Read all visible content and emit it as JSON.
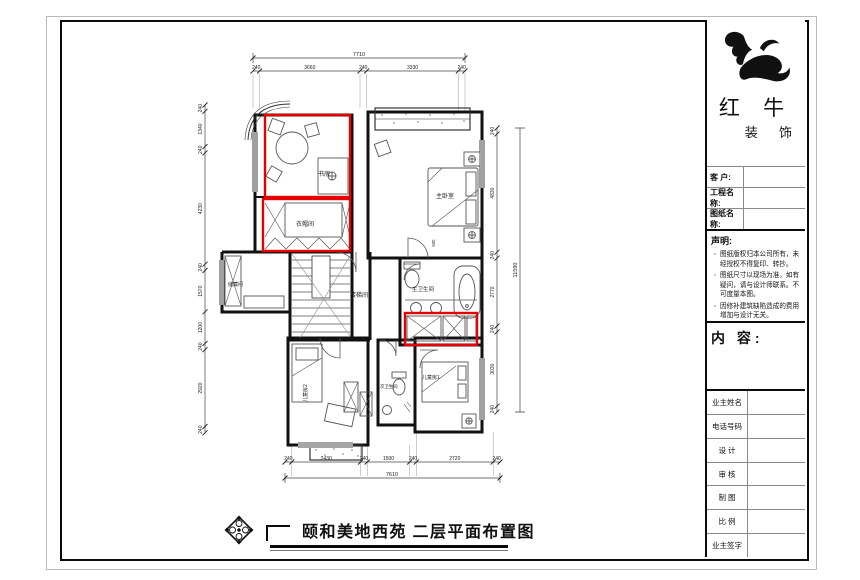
{
  "sheet": {
    "title": "颐和美地西苑  二层平面布置图"
  },
  "title_block": {
    "brand_main": "红 牛",
    "brand_sub": "装 饰",
    "fields": [
      {
        "label": "客  户:"
      },
      {
        "label": "工程名称:"
      },
      {
        "label": "图纸名称:"
      }
    ],
    "statement_heading": "声明:",
    "statement_items": [
      "图纸版权归本公司所有，未经授权不得复印、转抄。",
      "图纸尺寸以现场为准，如有疑问，请与设计师联系。不可度量本图。",
      "因修补建筑缺陷造成的费用增加与设计无关。"
    ],
    "content_label": "内 容:",
    "bottom_fields": [
      {
        "label": "业主姓名"
      },
      {
        "label": "电话号码"
      },
      {
        "label": "设 计"
      },
      {
        "label": "审 核"
      },
      {
        "label": "制 图"
      },
      {
        "label": "比 例"
      },
      {
        "label": "业主签字"
      }
    ]
  },
  "drawing": {
    "rooms": {
      "study": "书房",
      "cloakroom": "衣帽间",
      "master_bedroom": "主卧室",
      "storage": "储藏间",
      "stairwell": "楼梯间",
      "master_bath": "主卫生间",
      "second_bath": "次卫生间",
      "kids_room_2": "儿童房2",
      "kids_room_1": "儿童房1"
    },
    "dims": {
      "top_total": "7710",
      "top_segments": [
        "240",
        "3660",
        "240",
        "3330",
        "240"
      ],
      "bottom_segments": [
        "240",
        "2430",
        "240",
        "1500",
        "240",
        "2720",
        "240"
      ],
      "bottom_total": "7610",
      "left_segments": [
        "240",
        "1340",
        "240",
        "4230",
        "240",
        "1570",
        "1200",
        "240",
        "2920",
        "240"
      ],
      "right_segments": [
        "240",
        "4830",
        "240",
        "2770",
        "240",
        "3030",
        "240"
      ],
      "right_total": "11590",
      "misc": [
        "600"
      ]
    },
    "colors": {
      "highlight": "#e60000",
      "walls": "#111111"
    }
  }
}
